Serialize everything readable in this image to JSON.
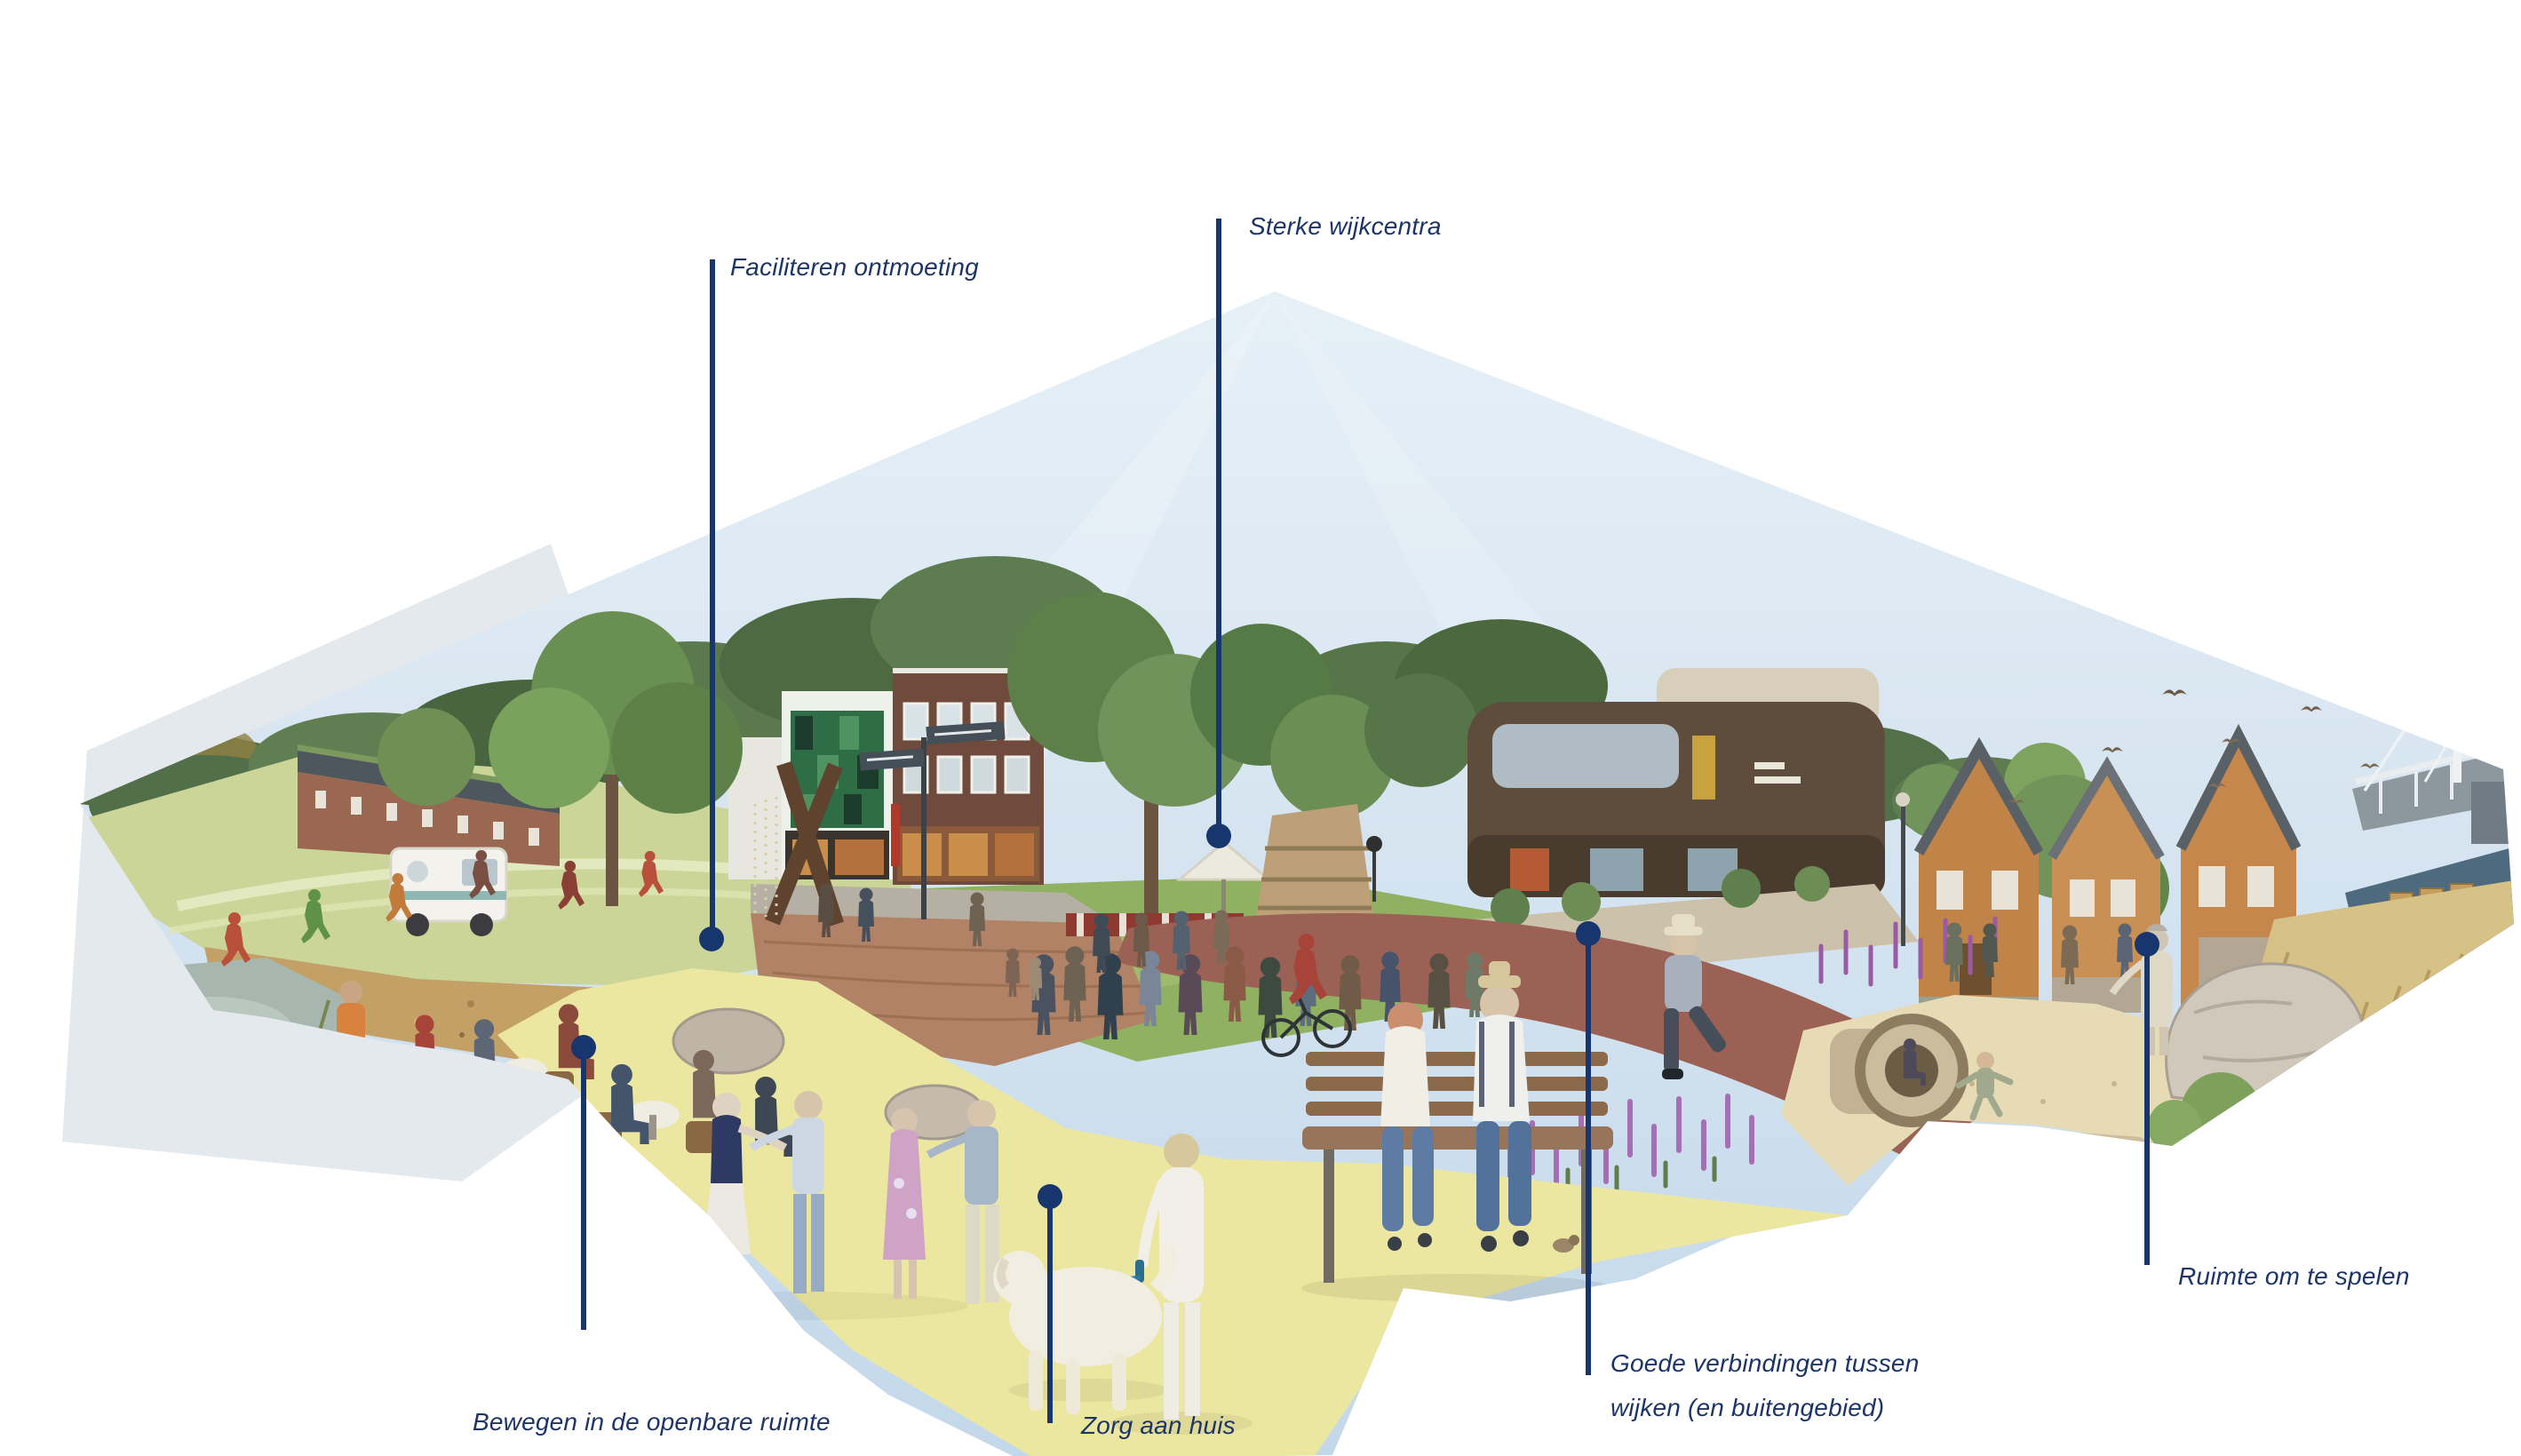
{
  "figure": {
    "type": "annotated-urban-vision-illustration",
    "language": "nl",
    "callouts": [
      {
        "id": "faciliteren",
        "label": "Faciliteren ontmoeting"
      },
      {
        "id": "sterke",
        "label": "Sterke wijkcentra"
      },
      {
        "id": "bewegen",
        "label": "Bewegen in de openbare ruimte"
      },
      {
        "id": "zorg",
        "label": "Zorg aan huis"
      },
      {
        "id": "verbindingen",
        "label": "Goede verbindingen tussen",
        "label2": "wijken (en buitengebied)"
      },
      {
        "id": "spelen",
        "label": "Ruimte om te spelen"
      }
    ]
  },
  "colors": {
    "accent_navy": "#18366e",
    "label_text": "#1d3566",
    "highlight_yellow": "#ece7a0",
    "sky_blue": "#cfe0ec",
    "background": "#ffffff"
  }
}
